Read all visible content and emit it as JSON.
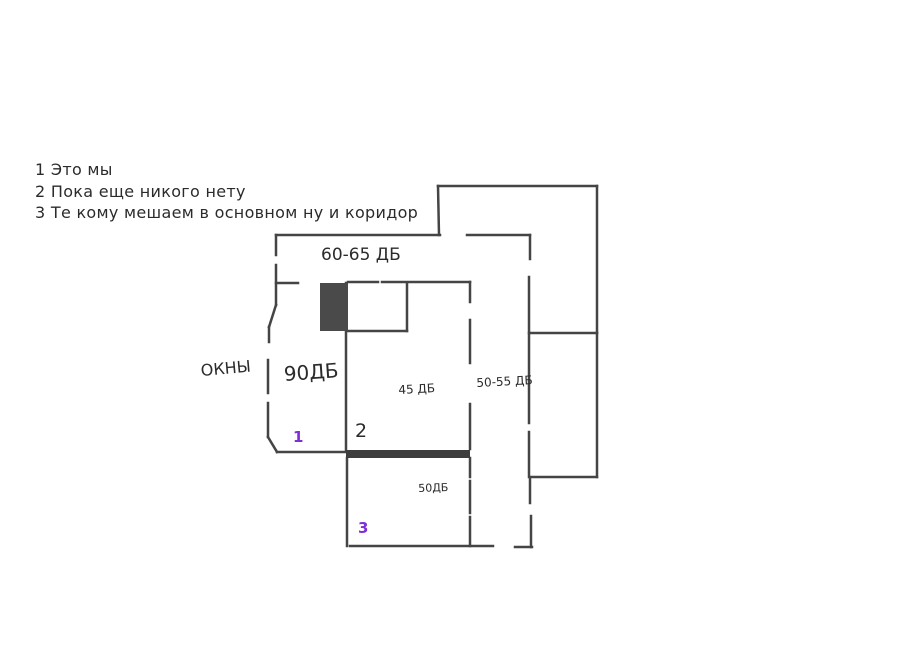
{
  "canvas": {
    "width": 908,
    "height": 652,
    "background": "#ffffff"
  },
  "colors": {
    "ink": "#2b2b2b",
    "wall": "#454545",
    "purple": "#7e2fd6",
    "block_fill": "#4a4a4a",
    "bar_fill": "#3d3d3d"
  },
  "legend": {
    "lines": [
      "1 Это мы",
      "2 Пока еще никого нету",
      "3 Те кому мешаем в основном ну и коридор"
    ]
  },
  "plan": {
    "stroke_width": 2.5,
    "labels": [
      {
        "name": "label-60-65-db",
        "text": "60-65 ДБ",
        "x": 321,
        "y": 245,
        "size": 17,
        "color": "ink",
        "rot": 0,
        "bold": false
      },
      {
        "name": "label-okna",
        "text": "ОКНЫ",
        "x": 200,
        "y": 361,
        "size": 16,
        "color": "ink",
        "rot": -5,
        "bold": false
      },
      {
        "name": "label-90-db",
        "text": "90ДБ",
        "x": 283,
        "y": 362,
        "size": 20,
        "color": "ink",
        "rot": -4,
        "bold": false
      },
      {
        "name": "label-45-db",
        "text": "45 ДБ",
        "x": 398,
        "y": 383,
        "size": 12,
        "color": "ink",
        "rot": -3,
        "bold": false
      },
      {
        "name": "label-50-55-db",
        "text": "50-55 ДБ",
        "x": 476,
        "y": 376,
        "size": 12,
        "color": "ink",
        "rot": -3,
        "bold": false
      },
      {
        "name": "label-50-db",
        "text": "50ДБ",
        "x": 418,
        "y": 482,
        "size": 11,
        "color": "ink",
        "rot": -2,
        "bold": false
      },
      {
        "name": "marker-room-1",
        "text": "1",
        "x": 293,
        "y": 428,
        "size": 15,
        "color": "purple",
        "rot": 0,
        "bold": true
      },
      {
        "name": "marker-room-2",
        "text": "2",
        "x": 355,
        "y": 420,
        "size": 19,
        "color": "ink",
        "rot": 0,
        "bold": false
      },
      {
        "name": "marker-room-3",
        "text": "3",
        "x": 358,
        "y": 519,
        "size": 15,
        "color": "purple",
        "rot": 0,
        "bold": true
      }
    ],
    "wall_segments": [
      [
        276,
        235,
        440,
        235
      ],
      [
        439,
        235,
        438,
        186
      ],
      [
        438,
        186,
        597,
        186
      ],
      [
        597,
        186,
        597,
        333
      ],
      [
        530,
        333,
        597,
        333
      ],
      [
        597,
        333,
        597,
        477
      ],
      [
        532,
        477,
        597,
        477
      ],
      [
        467,
        235,
        530,
        235
      ],
      [
        530,
        235,
        530,
        259
      ],
      [
        529,
        277,
        529,
        333
      ],
      [
        529,
        333,
        529,
        423
      ],
      [
        529,
        432,
        529,
        477
      ],
      [
        530,
        477,
        530,
        503
      ],
      [
        531,
        516,
        531,
        547
      ],
      [
        515,
        547,
        532,
        547
      ],
      [
        276,
        235,
        276,
        255
      ],
      [
        276,
        265,
        276,
        305
      ],
      [
        276,
        305,
        269,
        327
      ],
      [
        269,
        327,
        269,
        342
      ],
      [
        268,
        360,
        268,
        393
      ],
      [
        268,
        403,
        268,
        437
      ],
      [
        268,
        437,
        277,
        452
      ],
      [
        277,
        452,
        346,
        452
      ],
      [
        276,
        283,
        298,
        283
      ],
      [
        348,
        282,
        378,
        282
      ],
      [
        382,
        282,
        470,
        282
      ],
      [
        407,
        283,
        407,
        331
      ],
      [
        348,
        331,
        407,
        331
      ],
      [
        346,
        283,
        346,
        450
      ],
      [
        347,
        458,
        347,
        546
      ],
      [
        350,
        546,
        493,
        546
      ],
      [
        470,
        282,
        470,
        302
      ],
      [
        470,
        320,
        470,
        363
      ],
      [
        470,
        404,
        470,
        449
      ],
      [
        470,
        458,
        470,
        477
      ],
      [
        470,
        481,
        470,
        513
      ],
      [
        470,
        517,
        470,
        546
      ]
    ],
    "filled_rects": [
      {
        "name": "door-block",
        "x": 320,
        "y": 283,
        "w": 28,
        "h": 48,
        "fill": "block_fill"
      },
      {
        "name": "thick-wall-bar",
        "x": 346,
        "y": 450,
        "w": 124,
        "h": 8,
        "fill": "bar_fill"
      }
    ]
  }
}
